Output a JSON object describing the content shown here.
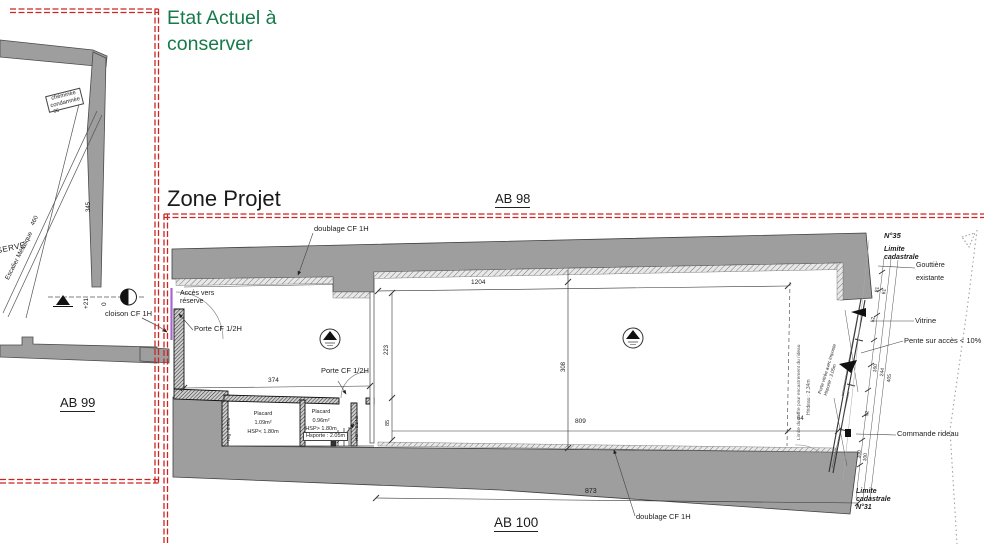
{
  "colors": {
    "boundary_red": "#cc2420",
    "title_green": "#177a4a",
    "wall_gray": "#9e9e9e",
    "cloison_violet": "#a668d0"
  },
  "etat": {
    "title": "Etat Actuel à\nconserver",
    "ab99": "AB 99",
    "cheminee": "chéminée\ncondamnée",
    "dim06": "06",
    "reserve": "RESERVE",
    "escalier": "Escalier Métalique",
    "dim460": "460",
    "dim345": "345",
    "plus21": "+21",
    "zero": "0",
    "cloison": "cloison CF 1H"
  },
  "zone": {
    "title": "Zone Projet",
    "ab98": "AB 98",
    "ab100": "AB 100",
    "doublage_top": "doublage CF 1H",
    "doublage_bottom": "doublage CF 1H",
    "acces": "Accès vers\nréserve",
    "porte1": "Porte CF 1/2H",
    "porte2": "Porte CF 1/2H",
    "hsporte": "Hsporte : 2.05m",
    "placard1": "Placard\n1.09m²\nHSP< 1.80m",
    "placard2": "Placard\n0.96m²\nHSP> 1.80m",
    "htg": "Htg : 0.97m",
    "hsp2": "HSP : 2.24m",
    "d374": "374",
    "d1204": "1204",
    "d223": "223",
    "d85": "85",
    "d308": "308",
    "d809": "809",
    "d64": "64",
    "d873": "873",
    "coffre": "Limite du coffre pour encastrement du rideau",
    "hrideau": "Hrideau : 2.34m",
    "porte_vitree": "Porte vitrée avec imposte\nHsporte : 2.05m"
  },
  "right": {
    "n35": "N°35",
    "limite_top": "Limite\ncadastrale",
    "gouttiere": "Gouttière\nexistante",
    "vitrine": "Vitrine",
    "pente": "Pente sur accès < 10%",
    "commande": "Commande rideau",
    "limite_bottom": "Limite\ncadastrale\nN°31",
    "d81": "81",
    "d61": "61",
    "d52a": "52",
    "d160": "160",
    "d244": "244",
    "d405": "405",
    "d52b": "52",
    "d100a": "100",
    "d100b": "100"
  }
}
